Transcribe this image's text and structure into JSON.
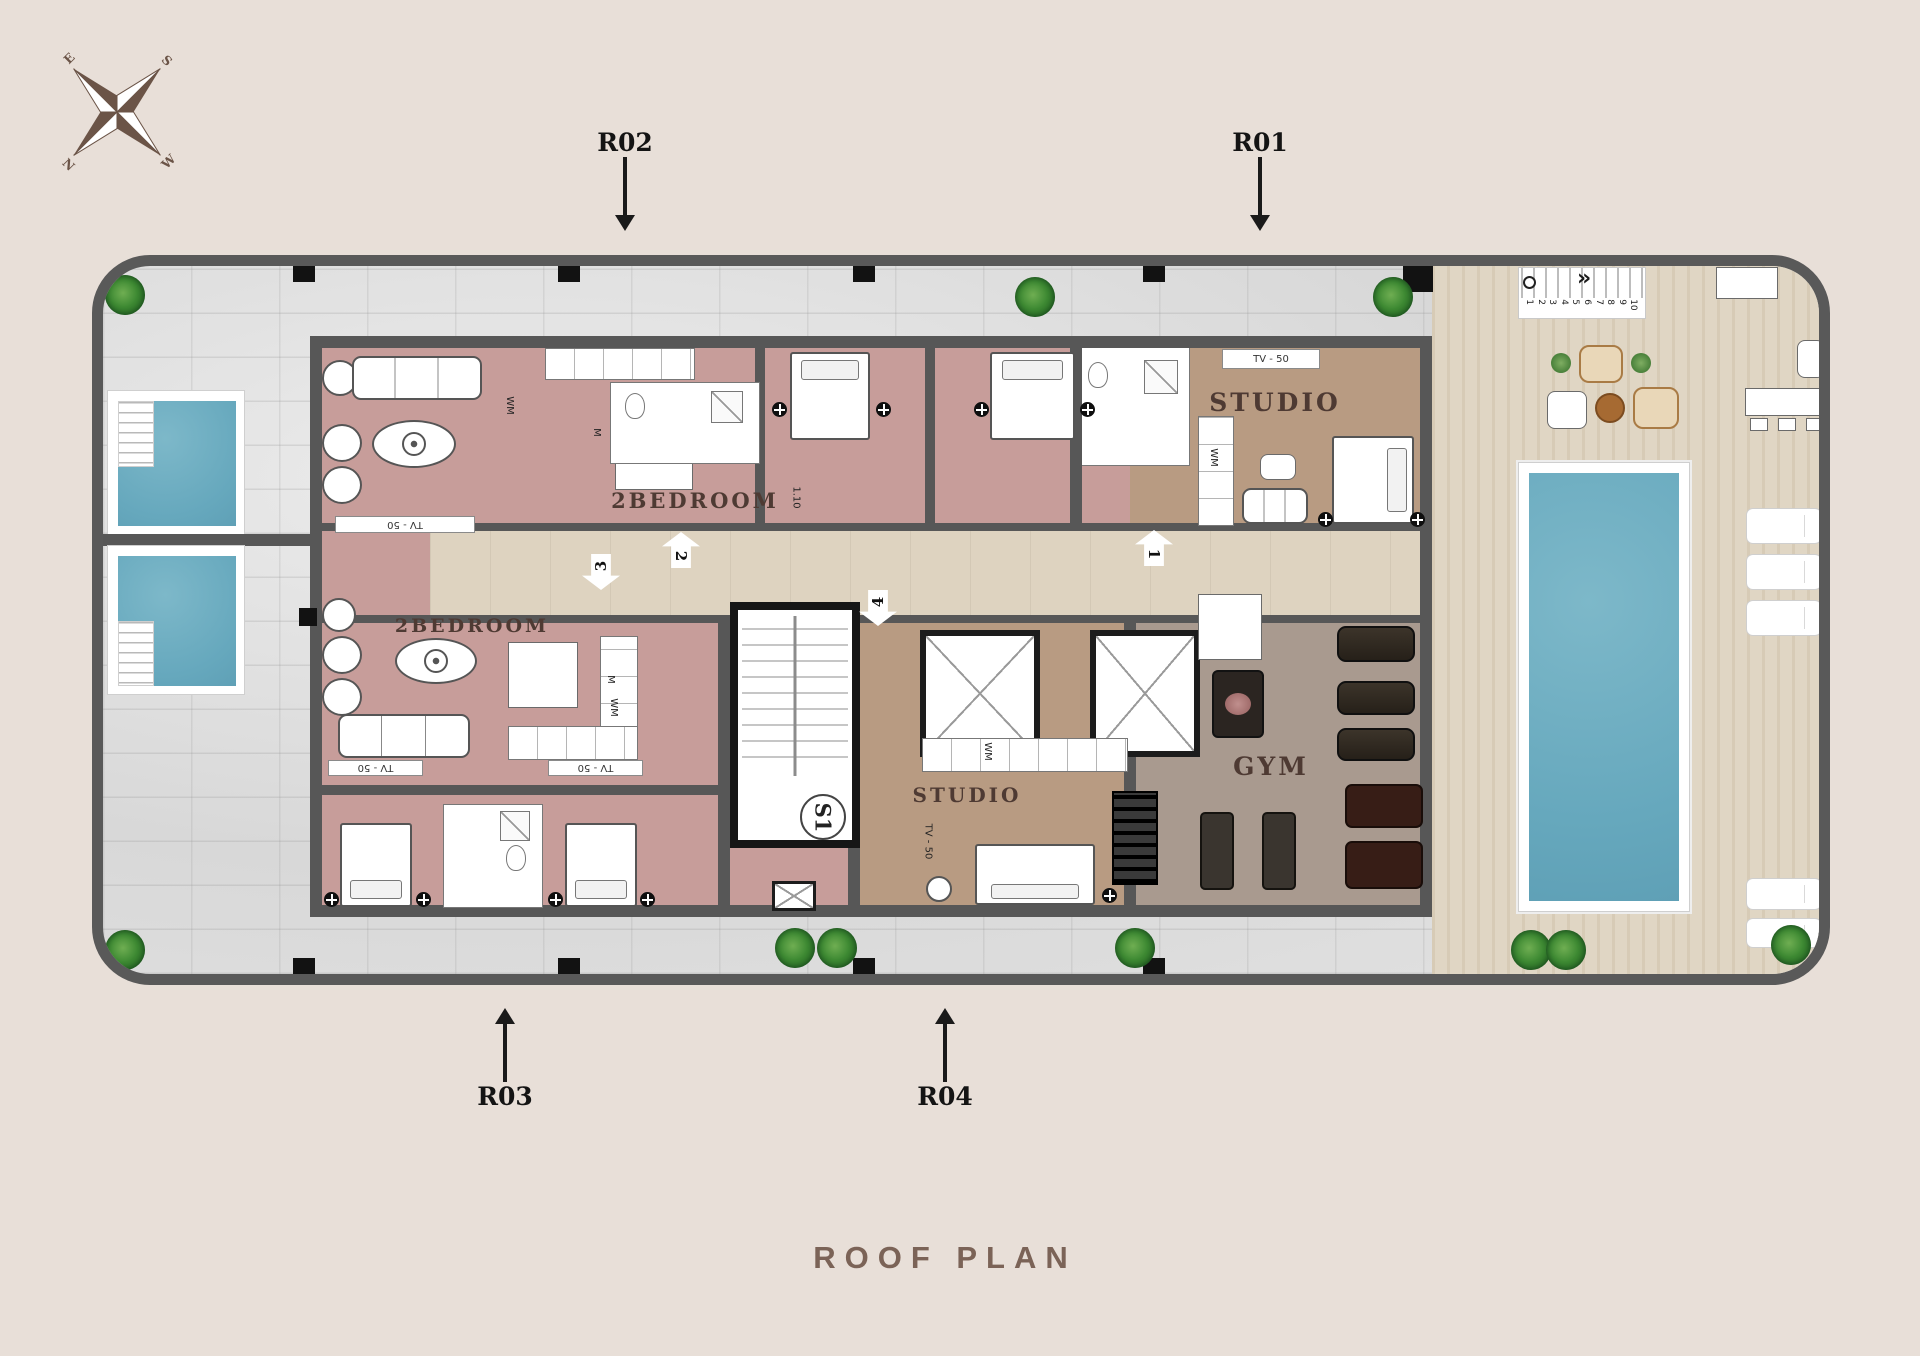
{
  "title": "ROOF  PLAN",
  "compass": {
    "n": "N",
    "e": "E",
    "s": "S",
    "w": "W"
  },
  "callouts": {
    "r01": "R01",
    "r02": "R02",
    "r03": "R03",
    "r04": "R04"
  },
  "rooms": {
    "two_bedroom_top": "2BEDROOM",
    "two_bedroom_left": "2BEDROOM",
    "studio_top": "STUDIO",
    "studio_bottom": "STUDIO",
    "gym": "GYM",
    "stair_core": "S1"
  },
  "annotations": {
    "tv": "TV - 50",
    "wm": "WM",
    "m": "M",
    "door_width": "1.10",
    "door_numbers": [
      "1",
      "2",
      "3",
      "4"
    ],
    "stair_steps": [
      "1",
      "2",
      "3",
      "4",
      "5",
      "6",
      "7",
      "8",
      "9",
      "10"
    ],
    "deck_stair_arrow": "»"
  },
  "colors": {
    "background": "#e8dfd8",
    "outer_wall": "#595959",
    "core_wall": "#181818",
    "terrace_tile": "#dcdcdc",
    "bedroom_floor": "#c79d9a",
    "studio_floor": "#b89b82",
    "gym_floor": "#a99a8f",
    "corridor_floor": "#ded3c0",
    "deck_wood": "#ddd2bf",
    "pool_water": "#6cadc0",
    "plant_green": "#3e8a33",
    "title_text": "#7b6357",
    "room_label_text": "#4e3a33"
  }
}
